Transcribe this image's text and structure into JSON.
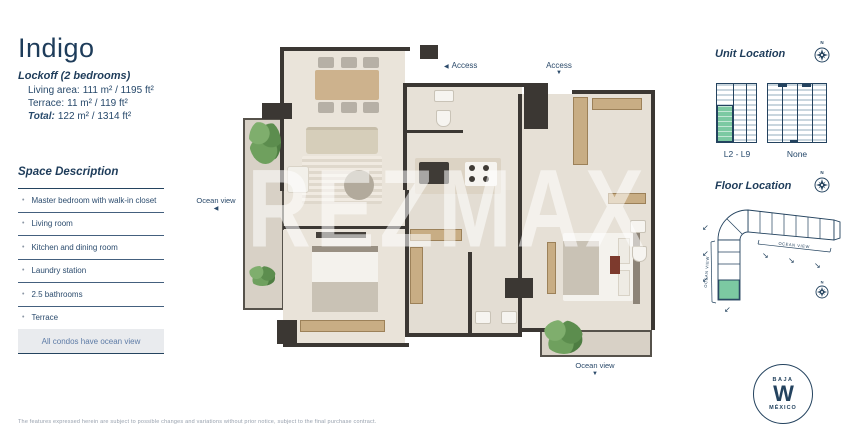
{
  "header": {
    "title": "Indigo",
    "subtitle": "Lockoff  (2 bedrooms)",
    "lines": [
      {
        "label": "Living area:",
        "value": "111 m² / 1195 ft²"
      },
      {
        "label": "Terrace:",
        "value": "11 m² / 119 ft²"
      },
      {
        "label": "Total:",
        "value": "122 m² / 1314 ft²"
      }
    ]
  },
  "space_description": {
    "heading": "Space Description",
    "items": [
      "Master bedroom with walk-in closet",
      "Living room",
      "Kitchen and dining room",
      "Laundry station",
      "2.5 bathrooms",
      "Terrace"
    ],
    "note": "All condos have ocean view"
  },
  "floor_plan": {
    "watermark": "REZMAX",
    "access_left_label": "Access",
    "access_top_label": "Access",
    "ocean_view_left_label": "Ocean view",
    "ocean_view_bottom_label": "Ocean view"
  },
  "unit_location": {
    "heading": "Unit Location",
    "building_a_label": "L2 - L9",
    "building_b_label": "None"
  },
  "floor_location": {
    "heading": "Floor Location",
    "ocean_view_wing_left": "OCEAN VIEW",
    "ocean_view_wing_top": "OCEAN VIEW"
  },
  "compass": {
    "north": "N"
  },
  "logo": {
    "top": "BAJA",
    "mark": "W",
    "bottom": "MÉXICO"
  },
  "disclaimer": "The features expressed herein are subject to possible changes and variations without prior notice, subject to the final purchase contract.",
  "icons": {
    "triangle_left": "◀",
    "triangle_down": "▼",
    "arrow_sw": "↙",
    "arrow_se": "↘"
  },
  "colors": {
    "navy": "#1e3c5a",
    "highlight_green": "#7cc9a2"
  }
}
